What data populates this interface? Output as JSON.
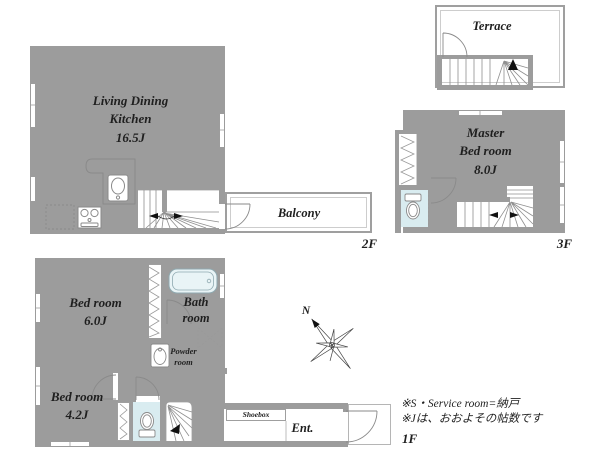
{
  "plan": {
    "floor2": {
      "floor_label": "2F",
      "ldk": {
        "line1": "Living Dining",
        "line2": "Kitchen",
        "size": "16.5J"
      },
      "balcony": "Balcony"
    },
    "floor3": {
      "floor_label": "3F",
      "terrace": "Terrace",
      "master": {
        "line1": "Master",
        "line2": "Bed room",
        "size": "8.0J"
      }
    },
    "floor1": {
      "floor_label": "1F",
      "bedroom_6": {
        "name": "Bed room",
        "size": "6.0J"
      },
      "bedroom_4": {
        "name": "Bed room",
        "size": "4.2J"
      },
      "bath": {
        "line1": "Bath",
        "line2": "room"
      },
      "powder": {
        "line1": "Powder",
        "line2": "room"
      },
      "shoebox": "Shoebox",
      "entrance": "Ent."
    },
    "compass_label": "N",
    "notes": [
      "※S・Service room=納戸",
      "※Jは、おおよその帖数です"
    ]
  },
  "colors": {
    "wall": "#9c9c9c",
    "ldk_floor": "#fce8d8",
    "bedroom_floor": "#f6f4da",
    "wet_room_floor": "#d9ecf0",
    "bathtub_fill": "#e9f4f6",
    "thin_line": "#9f9f9f",
    "text": "#1f1f1f"
  }
}
